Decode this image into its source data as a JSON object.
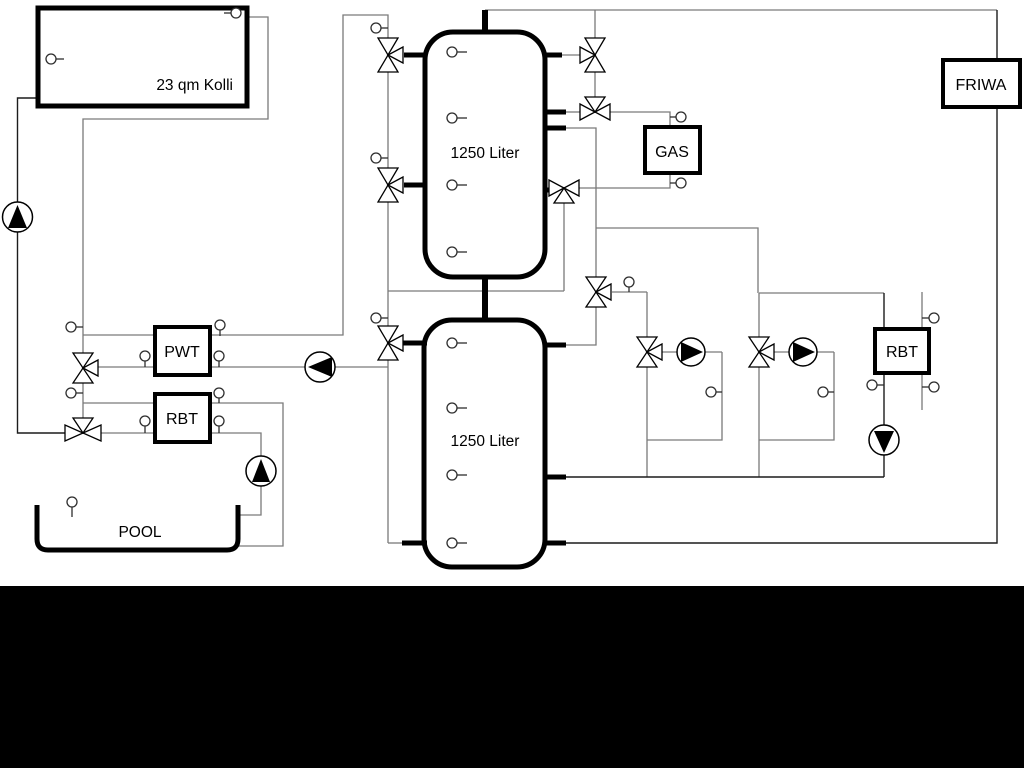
{
  "diagram": {
    "labels": {
      "collector": "23 qm Kolli",
      "tank_top": "1250 Liter",
      "tank_bottom": "1250 Liter",
      "pwt": "PWT",
      "rbt_left": "RBT",
      "rbt_right": "RBT",
      "gas": "GAS",
      "friwa": "FRIWA",
      "pool": "POOL"
    },
    "colors": {
      "background": "#ffffff",
      "bottom_band": "#000000",
      "pipe_gray": "#7a7a7a",
      "pipe_dark": "#1c1c1c",
      "outline_black": "#000000"
    }
  }
}
